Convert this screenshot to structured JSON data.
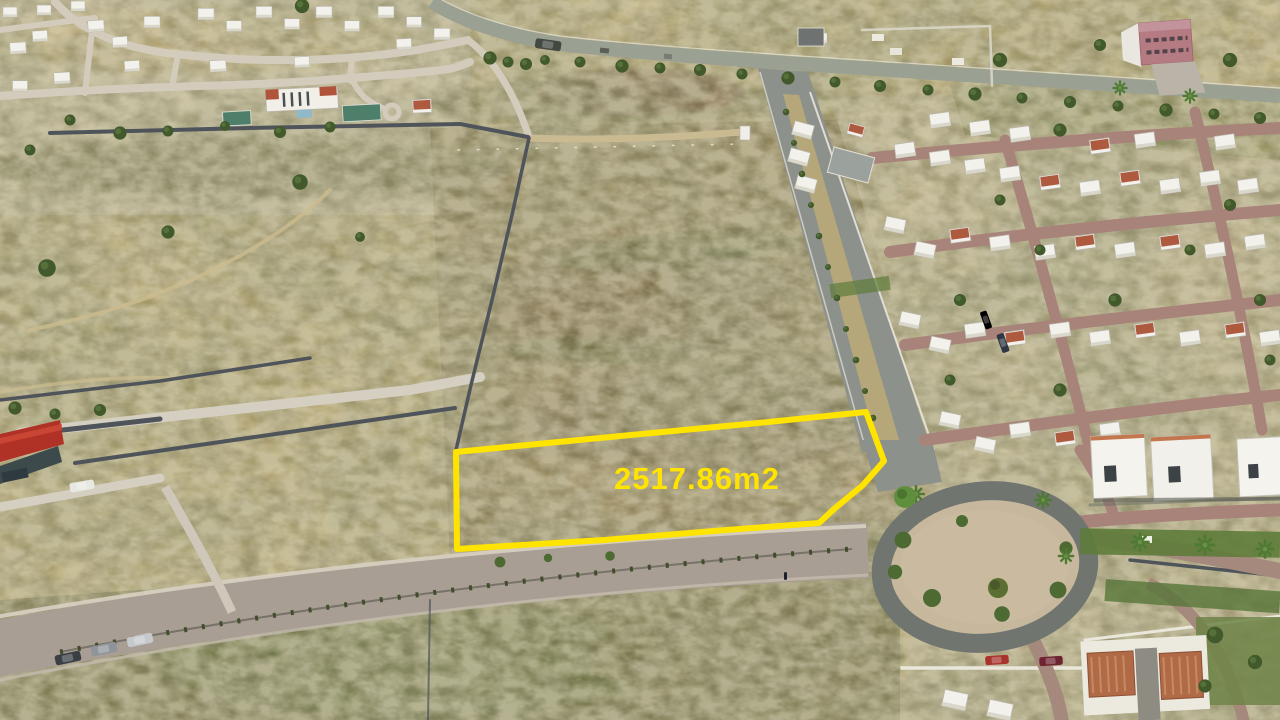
{
  "photo": {
    "kind": "aerial-drone-photo",
    "parcel": {
      "area_label": "2517.86m2",
      "outline_color": "#ffe400",
      "label_color": "#ffe400"
    },
    "palette": {
      "dry_grass": "#b3a26b",
      "scrub_green": "#5d6b38",
      "asphalt": "#8d918b",
      "paver_street": "#a8837a",
      "boulevard": "#a89e93",
      "concrete_road": "#d3ccbd",
      "gravel": "#c7b89d",
      "house_white": "#f2f1ec",
      "roof_terracotta": "#ae5a3e",
      "roof_red": "#b03226"
    }
  }
}
